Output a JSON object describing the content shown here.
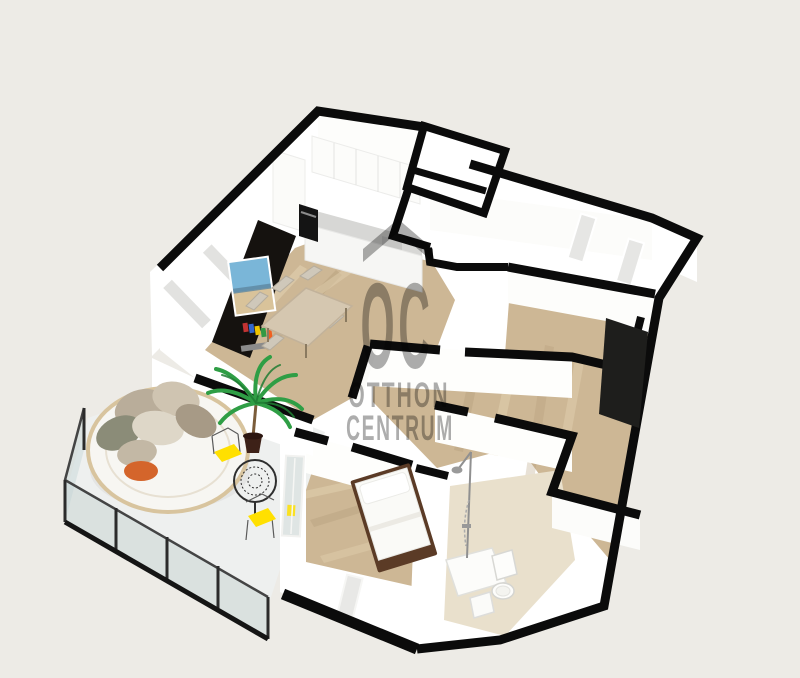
{
  "image": {
    "type": "3d-floor-plan-render",
    "width": 800,
    "height": 678
  },
  "watermark": {
    "monogram": "OC",
    "line1": "OTTHON",
    "line2": "CENTRUM",
    "roof_symbol": "roof-chevron",
    "color": "#a6a6a6"
  },
  "colors": {
    "background": "#edebe6",
    "wall_cap": "#0b0b0b",
    "wall_face": "#ffffff",
    "wood": "#cdb795",
    "wood_light": "#e4d3b2",
    "wood_dark": "#b29a77",
    "tile": "#e9e0cc",
    "balcony_floor": "#eef0ef",
    "tv_wall": "#15120f",
    "yellow": "#ffe000",
    "orange": "#d4652b",
    "green": "#2f9e45",
    "glass": "#c3d4d8",
    "bed_frame": "#5b3b26",
    "counter": "#d7d7d5"
  },
  "scene": {
    "rooms": [
      {
        "name": "living-dining-kitchen"
      },
      {
        "name": "entry-hall"
      },
      {
        "name": "utility-nook"
      },
      {
        "name": "room-northeast"
      },
      {
        "name": "room-east"
      },
      {
        "name": "bedroom"
      },
      {
        "name": "bathroom"
      },
      {
        "name": "balcony"
      }
    ],
    "furniture": [
      "tv-media-wall",
      "dining-table",
      "dining-chairs",
      "kitchen-cabinets",
      "oven",
      "kitchen-counter",
      "palm-plant",
      "round-daybed",
      "cushions",
      "orange-side-table",
      "bistro-table",
      "bistro-chairs-yellow",
      "double-bed",
      "shower-set",
      "toilet",
      "laundry-box",
      "glass-balustrade",
      "dark-wardrobe"
    ]
  }
}
